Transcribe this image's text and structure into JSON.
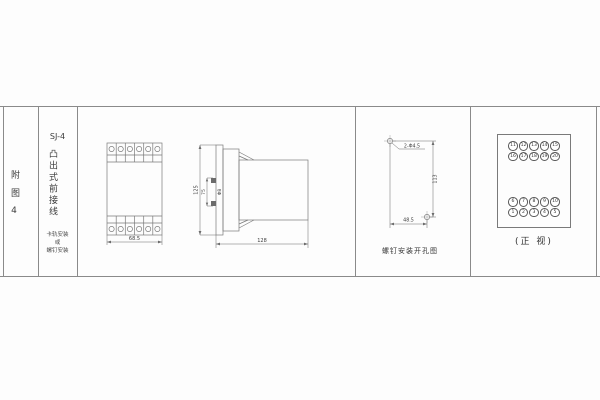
{
  "sheet": {
    "ref_label": "附图4",
    "model": "SJ-4",
    "type_label": "凸出式前接线",
    "mount_note_lines": [
      "卡轨安装",
      "或",
      "螺钉安装"
    ]
  },
  "front_view": {
    "width_dim": "68.5"
  },
  "side_view": {
    "height_dim": "125",
    "spacing_dim": "75",
    "stud_label": "Φ8",
    "depth_dim": "128"
  },
  "drill_view": {
    "holes_label": "2-Φ4.5",
    "height_dim": "113",
    "width_dim": "48.5",
    "caption": "螺钉安装开孔图"
  },
  "terminal_view": {
    "caption": "(正 视)",
    "rows": [
      [
        "11",
        "12",
        "13",
        "14",
        "15"
      ],
      [
        "16",
        "17",
        "18",
        "19",
        "20"
      ],
      [
        "6",
        "7",
        "8",
        "9",
        "10"
      ],
      [
        "1",
        "2",
        "3",
        "4",
        "5"
      ]
    ]
  },
  "colors": {
    "line": "#777777",
    "text": "#3c3c3c",
    "background": "#fdfdfd"
  }
}
